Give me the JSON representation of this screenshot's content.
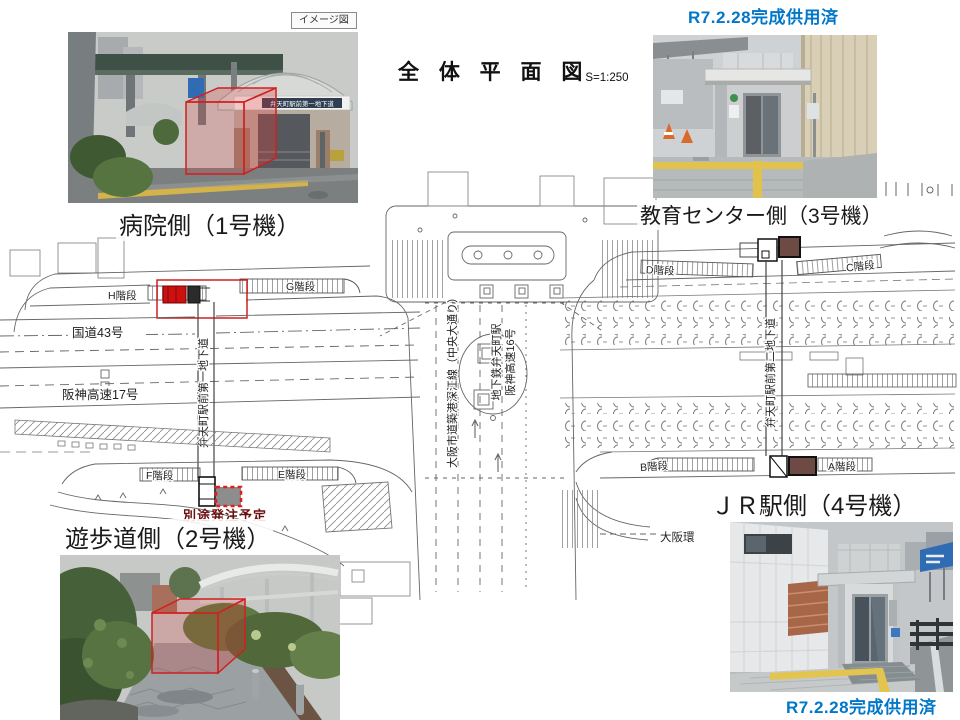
{
  "title": {
    "main": "全 体 平 面 図",
    "scale": "S=1:250"
  },
  "status": {
    "top": "R7.2.28完成供用済",
    "bottom": "R7.2.28完成供用済"
  },
  "tags": {
    "image_tag": "イメージ図",
    "pending_order": "別途発注予定"
  },
  "units": {
    "unit1": {
      "caption": "病院側（1号機）",
      "location": "hospital-side"
    },
    "unit2": {
      "caption": "遊歩道側（2号機）",
      "location": "promenade-side"
    },
    "unit3": {
      "caption": "教育センター側（3号機）",
      "location": "education-center-side"
    },
    "unit4": {
      "caption": "ＪＲ駅側（4号機）",
      "location": "jr-station-side"
    }
  },
  "photos": {
    "p1_sign": "弁天町駅前第一地下道"
  },
  "plan": {
    "roads": {
      "route43": "国道43号",
      "hanshin17": "阪神高速17号",
      "chuo_odori": "大阪市道築港深江線（中央大通り）",
      "hanshin16": "阪神高速16号",
      "partial_loop_line": "大阪環"
    },
    "station": "地下鉄弁天町駅",
    "underpass1": "弁天町駅前第一地下道",
    "underpass2": "弁天町駅前第二地下道",
    "stairs": {
      "a": "A階段",
      "b": "B階段",
      "c": "C階段",
      "d": "D階段",
      "e": "E階段",
      "f": "F階段",
      "g": "G階段",
      "h": "H階段"
    }
  },
  "colors": {
    "status_blue": "#0077C8",
    "pending_dark_red": "#6b1010",
    "highlight_red": "#cc1111",
    "existing_unit_fill": "#6e4a45",
    "planned_unit_fill": "#8d8d8d"
  }
}
